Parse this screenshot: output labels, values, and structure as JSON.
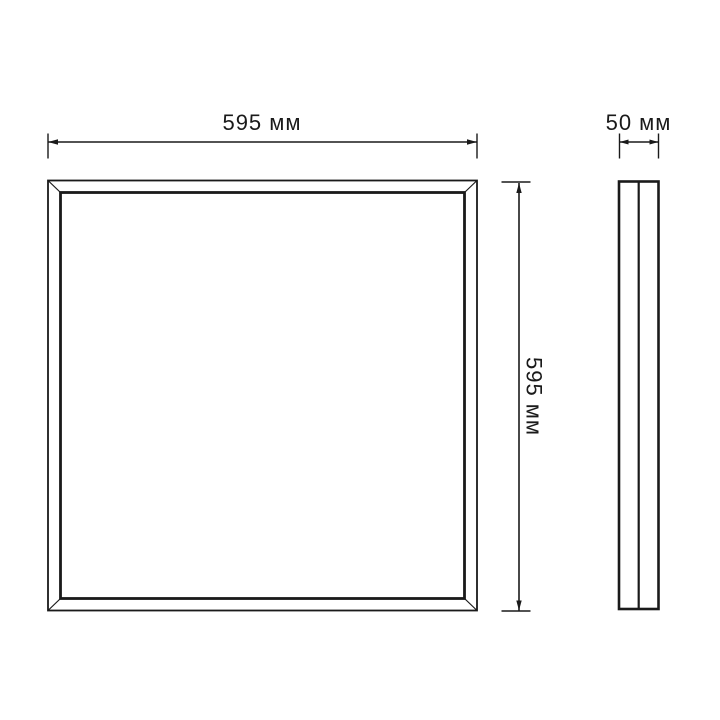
{
  "colors": {
    "background": "#ffffff",
    "line": "#1a1a1a"
  },
  "dimensions": {
    "front_width": {
      "label": "595 мм",
      "value": 595,
      "unit": "мм"
    },
    "front_height": {
      "label": "595 мм",
      "value": 595,
      "unit": "мм"
    },
    "side_depth": {
      "label": "50 мм",
      "value": 50,
      "unit": "мм"
    }
  }
}
